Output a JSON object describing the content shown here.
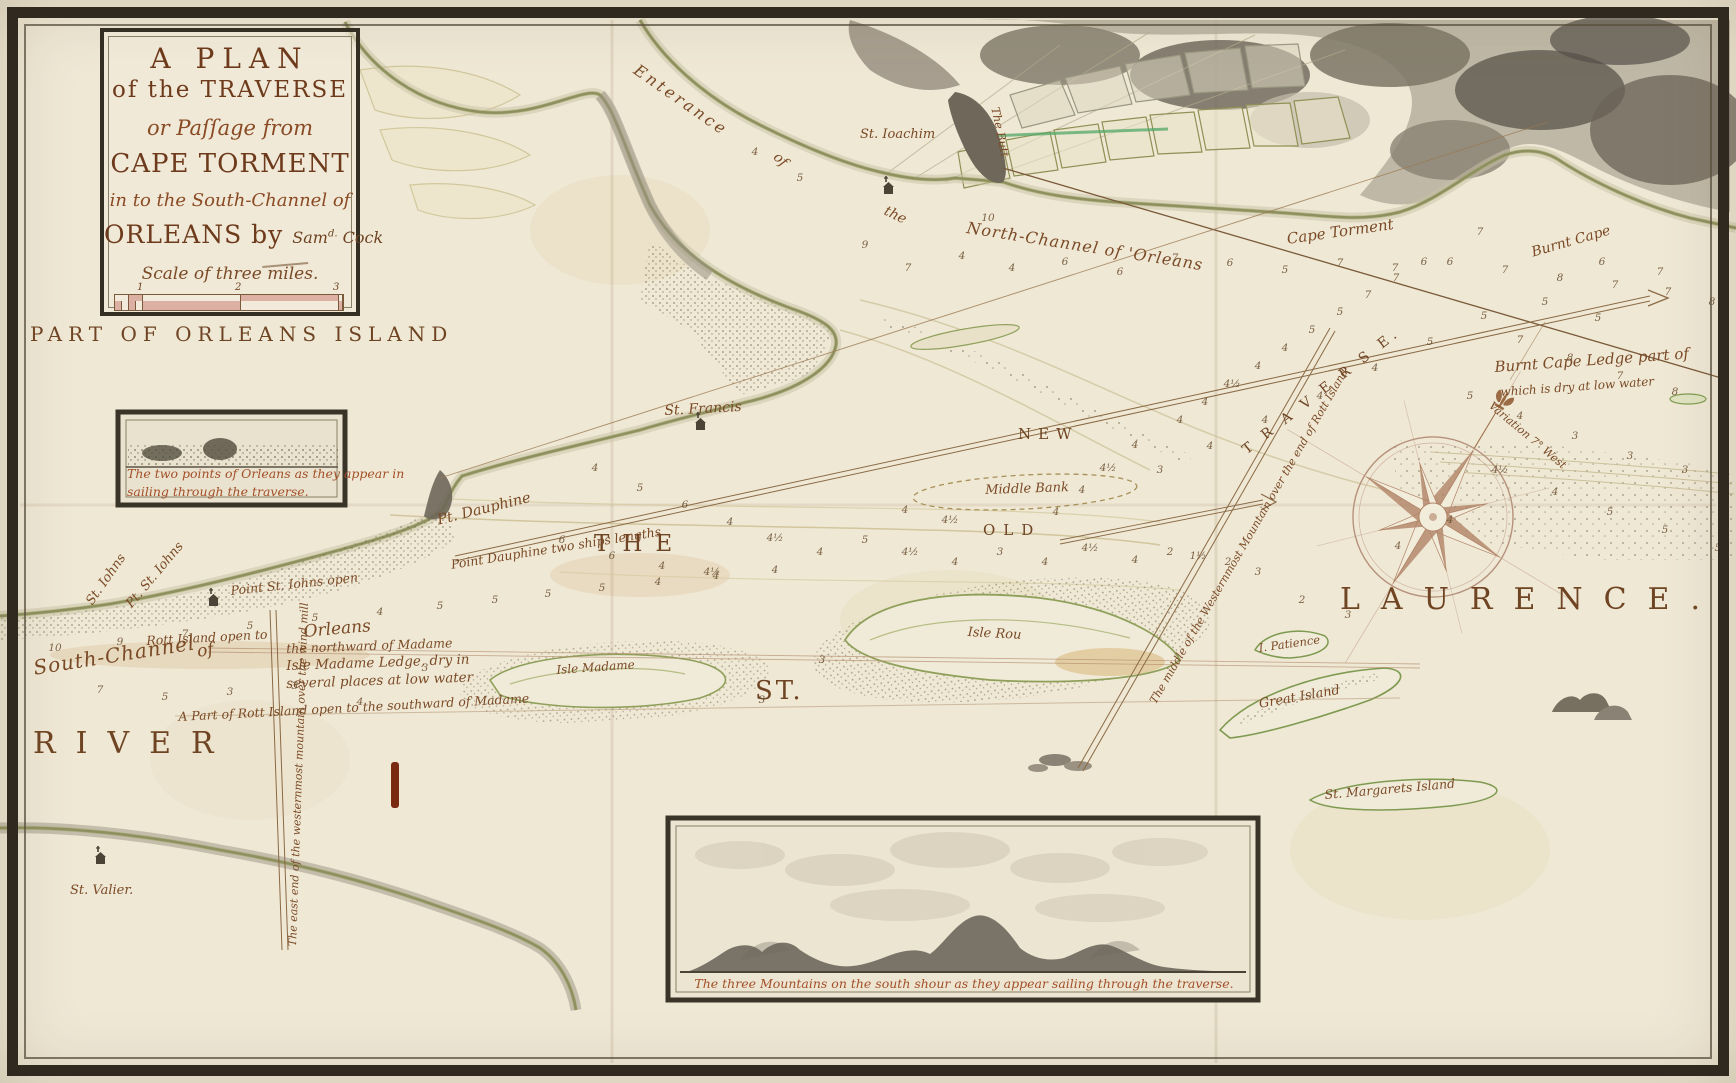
{
  "cartouche": {
    "line1": "A PLAN",
    "line2": "of the TRAVERSE",
    "line3": "or Paſſage from",
    "line4": "CAPE TORMENT",
    "line5": "in to the South-Channel of",
    "line6": "ORLEANS by",
    "signature_main": "Sam",
    "signature_sup": "d.",
    "signature_rest": " Cock",
    "scale_label": "Scale of three miles.",
    "scale_ticks": [
      "1",
      "2",
      "3"
    ]
  },
  "region_title": "PART OF ORLEANS ISLAND",
  "insets": {
    "orleans_points": {
      "caption_line1": "The two points of Orleans as they appear in",
      "caption_line2": "sailing through the traverse."
    },
    "three_mountains": {
      "caption": "The three Mountains on the south shour as they appear sailing through the traverse."
    }
  },
  "colors": {
    "ink": "#7a4a26",
    "title_ink": "#6e3a1c",
    "caption_red": "#a34f28",
    "paper": "#efe8d5",
    "frame": "#2f2920",
    "shore_green": "#9aa35e",
    "terrain_gray": "#7d7568",
    "scale_pink": "#ddb0a4"
  },
  "labels": [
    {
      "name": "region-title",
      "text": "PART OF ORLEANS ISLAND",
      "x": 30,
      "y": 324,
      "fs": 20,
      "ls": 6,
      "cls": "caps"
    },
    {
      "name": "enterance-label",
      "text": "Enterance",
      "x": 640,
      "y": 62,
      "fs": 16,
      "rot": 35,
      "ls": 3,
      "cls": "hand"
    },
    {
      "name": "enterance-of",
      "text": "of",
      "x": 780,
      "y": 150,
      "fs": 14,
      "rot": 42,
      "cls": "hand"
    },
    {
      "name": "enterance-the",
      "text": "the",
      "x": 888,
      "y": 204,
      "fs": 14,
      "rot": 26,
      "cls": "hand"
    },
    {
      "name": "north-channel-label",
      "text": "North-Channel of 'Orleans",
      "x": 968,
      "y": 220,
      "fs": 16,
      "rot": 9,
      "ls": 1,
      "cls": "hand"
    },
    {
      "name": "st-joachim-label",
      "text": "St. Ioachim",
      "x": 860,
      "y": 128,
      "fs": 13,
      "cls": "hand"
    },
    {
      "name": "the-butt-label",
      "text": "The Butt",
      "x": 1001,
      "y": 106,
      "fs": 11.5,
      "rot": 78,
      "cls": "hand"
    },
    {
      "name": "cape-torment-label",
      "text": "Cape Torment",
      "x": 1286,
      "y": 232,
      "fs": 15,
      "rot": -8,
      "cls": "hand"
    },
    {
      "name": "burnt-cape-label",
      "text": "Burnt Cape",
      "x": 1530,
      "y": 246,
      "fs": 14,
      "rot": -16,
      "cls": "hand"
    },
    {
      "name": "burnt-cape-ledge-label",
      "text": "Burnt Cape Ledge part of",
      "x": 1494,
      "y": 360,
      "fs": 15,
      "rot": -4,
      "cls": "hand"
    },
    {
      "name": "dry-at-low-water-label",
      "text": "which is dry at low water",
      "x": 1500,
      "y": 386,
      "fs": 12,
      "rot": -4,
      "cls": "hand"
    },
    {
      "name": "variation-label",
      "text": "Variation 7° West",
      "x": 1494,
      "y": 400,
      "fs": 11,
      "rot": 40,
      "cls": "hand"
    },
    {
      "name": "new-channel-label",
      "text": "NEW",
      "x": 1018,
      "y": 427,
      "fs": 15,
      "ls": 7,
      "cls": "caps"
    },
    {
      "name": "middle-bank-label",
      "text": "Middle Bank",
      "x": 985,
      "y": 484,
      "fs": 13,
      "rot": -2,
      "cls": "hand"
    },
    {
      "name": "old-channel-label",
      "text": "OLD",
      "x": 983,
      "y": 523,
      "fs": 15,
      "ls": 8,
      "cls": "caps"
    },
    {
      "name": "the-word",
      "text": "THE",
      "x": 594,
      "y": 532,
      "fs": 23,
      "ls": 13,
      "cls": "caps"
    },
    {
      "name": "st-word",
      "text": "ST.",
      "x": 755,
      "y": 678,
      "fs": 26,
      "ls": 3,
      "cls": "caps"
    },
    {
      "name": "laurence-word",
      "text": "LAURENCE.",
      "x": 1340,
      "y": 584,
      "fs": 30,
      "ls": 21,
      "cls": "caps"
    },
    {
      "name": "river-word",
      "text": "RIVER",
      "x": 33,
      "y": 728,
      "fs": 30,
      "ls": 20,
      "cls": "caps"
    },
    {
      "name": "traverse-word",
      "text": "T R A V E R S E.",
      "x": 1240,
      "y": 446,
      "fs": 14,
      "ls": 5,
      "rot": -38,
      "cls": "caps"
    },
    {
      "name": "st-francis-label",
      "text": "St. Francis",
      "x": 664,
      "y": 404,
      "fs": 14,
      "rot": -3,
      "cls": "hand"
    },
    {
      "name": "pt-dauphine-label",
      "text": "Pt. Dauphine",
      "x": 436,
      "y": 514,
      "fs": 14.5,
      "rot": -14,
      "cls": "hand"
    },
    {
      "name": "pt-dauphine-leading-label",
      "text": "Point Dauphine two ships lengths",
      "x": 450,
      "y": 558,
      "fs": 12.5,
      "rot": -9,
      "cls": "hand"
    },
    {
      "name": "st-johns-label",
      "text": "St. Iohns",
      "x": 84,
      "y": 600,
      "fs": 13,
      "rot": -55,
      "cls": "hand"
    },
    {
      "name": "pt-st-johns-label",
      "text": "Pt. St. Iohns",
      "x": 124,
      "y": 602,
      "fs": 13,
      "rot": -50,
      "cls": "hand"
    },
    {
      "name": "pt-st-johns-leading-label",
      "text": "Point St. Iohns open",
      "x": 230,
      "y": 584,
      "fs": 12.5,
      "rot": -6,
      "cls": "hand"
    },
    {
      "name": "south-channel-label",
      "text": "South-Channel",
      "x": 32,
      "y": 658,
      "fs": 20,
      "rot": -9,
      "ls": 1,
      "cls": "hand"
    },
    {
      "name": "south-channel-of",
      "text": "of",
      "x": 196,
      "y": 644,
      "fs": 17,
      "rot": -9,
      "cls": "hand"
    },
    {
      "name": "south-channel-orleans",
      "text": "Orleans",
      "x": 303,
      "y": 624,
      "fs": 17,
      "rot": -5,
      "cls": "hand"
    },
    {
      "name": "rott-island-north-label",
      "text": "Rott Island open to",
      "x": 146,
      "y": 634,
      "fs": 12.5,
      "rot": -3,
      "cls": "hand"
    },
    {
      "name": "northward-madame-label",
      "text": "the northward of Madame",
      "x": 286,
      "y": 642,
      "fs": 12.5,
      "rot": -2,
      "cls": "hand"
    },
    {
      "name": "madame-ledge-label-1",
      "text": "Isle Madame Ledge, dry in",
      "x": 286,
      "y": 659,
      "fs": 13.5,
      "rot": -2,
      "cls": "hand"
    },
    {
      "name": "madame-ledge-label-2",
      "text": "several places at low water",
      "x": 286,
      "y": 677,
      "fs": 13.5,
      "rot": -2,
      "cls": "hand"
    },
    {
      "name": "rott-island-south-label",
      "text": "A Part of Rott Island open to the southward of Madame",
      "x": 178,
      "y": 710,
      "fs": 12.5,
      "rot": -3,
      "cls": "hand"
    },
    {
      "name": "isle-madame-label",
      "text": "Isle Madame",
      "x": 556,
      "y": 664,
      "fs": 12,
      "rot": -4,
      "cls": "hand"
    },
    {
      "name": "isle-rou-label",
      "text": "Isle Rou",
      "x": 968,
      "y": 626,
      "fs": 13,
      "rot": 3,
      "cls": "hand"
    },
    {
      "name": "patience-label",
      "text": "I. Patience",
      "x": 1258,
      "y": 642,
      "fs": 11.5,
      "rot": -8,
      "cls": "hand"
    },
    {
      "name": "great-island-label",
      "text": "Great Island",
      "x": 1258,
      "y": 698,
      "fs": 13,
      "rot": -10,
      "cls": "hand"
    },
    {
      "name": "st-margarets-label",
      "text": "St. Margarets Island",
      "x": 1324,
      "y": 788,
      "fs": 12.5,
      "rot": -5,
      "cls": "hand"
    },
    {
      "name": "st-valier-label",
      "text": "St. Valier.",
      "x": 70,
      "y": 884,
      "fs": 13,
      "cls": "hand"
    },
    {
      "name": "east-end-bearing-label",
      "text": "The east end of the westernmost mountain over the wind mill",
      "x": 287,
      "y": 946,
      "fs": 11,
      "rot": -88,
      "cls": "hand"
    },
    {
      "name": "middle-mountain-bearing-label",
      "text": "The middle of the Westernmost Mountain over the end of Rott Island",
      "x": 1148,
      "y": 700,
      "fs": 11,
      "rot": -60,
      "cls": "hand"
    }
  ],
  "soundings": [
    [
      755,
      152,
      "4"
    ],
    [
      800,
      178,
      "5"
    ],
    [
      988,
      218,
      "10"
    ],
    [
      865,
      245,
      "9"
    ],
    [
      908,
      268,
      "7"
    ],
    [
      962,
      256,
      "4"
    ],
    [
      1012,
      268,
      "4"
    ],
    [
      1065,
      262,
      "6"
    ],
    [
      1120,
      272,
      "6"
    ],
    [
      1175,
      258,
      "7"
    ],
    [
      1230,
      263,
      "6"
    ],
    [
      1285,
      270,
      "5"
    ],
    [
      1340,
      263,
      "7"
    ],
    [
      1395,
      268,
      "7"
    ],
    [
      1450,
      262,
      "6"
    ],
    [
      1505,
      270,
      "7"
    ],
    [
      1560,
      278,
      "8"
    ],
    [
      1615,
      285,
      "7"
    ],
    [
      1668,
      292,
      "7"
    ],
    [
      1712,
      302,
      "8"
    ],
    [
      1480,
      232,
      "7"
    ],
    [
      1602,
      262,
      "6"
    ],
    [
      1660,
      272,
      "7"
    ],
    [
      1180,
      420,
      "4"
    ],
    [
      1205,
      402,
      "4"
    ],
    [
      1232,
      384,
      "4½"
    ],
    [
      1258,
      366,
      "4"
    ],
    [
      1285,
      348,
      "4"
    ],
    [
      1312,
      330,
      "5"
    ],
    [
      1340,
      312,
      "5"
    ],
    [
      1368,
      295,
      "7"
    ],
    [
      1396,
      278,
      "7"
    ],
    [
      1424,
      262,
      "6"
    ],
    [
      1135,
      445,
      "4"
    ],
    [
      1108,
      468,
      "4½"
    ],
    [
      1082,
      490,
      "4"
    ],
    [
      1056,
      512,
      "4"
    ],
    [
      1160,
      470,
      "3"
    ],
    [
      1210,
      446,
      "4"
    ],
    [
      1265,
      420,
      "4"
    ],
    [
      1320,
      396,
      "4"
    ],
    [
      1375,
      368,
      "4"
    ],
    [
      1430,
      342,
      "5"
    ],
    [
      1484,
      316,
      "5"
    ],
    [
      1520,
      340,
      "7"
    ],
    [
      1570,
      358,
      "8"
    ],
    [
      1620,
      376,
      "7"
    ],
    [
      1675,
      392,
      "8"
    ],
    [
      1722,
      408,
      "7"
    ],
    [
      1545,
      302,
      "5"
    ],
    [
      1598,
      318,
      "5"
    ],
    [
      1470,
      396,
      "5"
    ],
    [
      1520,
      416,
      "4"
    ],
    [
      1575,
      436,
      "3"
    ],
    [
      1630,
      456,
      "3"
    ],
    [
      1685,
      470,
      "3"
    ],
    [
      1726,
      486,
      "3"
    ],
    [
      1500,
      470,
      "4½"
    ],
    [
      1555,
      492,
      "4"
    ],
    [
      1610,
      512,
      "5"
    ],
    [
      1665,
      530,
      "5"
    ],
    [
      1718,
      548,
      "5"
    ],
    [
      1450,
      520,
      "4"
    ],
    [
      1398,
      546,
      "4"
    ],
    [
      595,
      468,
      "4"
    ],
    [
      640,
      488,
      "5"
    ],
    [
      685,
      505,
      "6"
    ],
    [
      730,
      522,
      "4"
    ],
    [
      775,
      538,
      "4½"
    ],
    [
      820,
      552,
      "4"
    ],
    [
      865,
      540,
      "5"
    ],
    [
      910,
      552,
      "4½"
    ],
    [
      955,
      562,
      "4"
    ],
    [
      1000,
      552,
      "3"
    ],
    [
      1045,
      562,
      "4"
    ],
    [
      1090,
      548,
      "4½"
    ],
    [
      1135,
      560,
      "4"
    ],
    [
      562,
      540,
      "6"
    ],
    [
      612,
      556,
      "6"
    ],
    [
      662,
      566,
      "4"
    ],
    [
      712,
      572,
      "4½"
    ],
    [
      905,
      510,
      "4"
    ],
    [
      950,
      520,
      "4½"
    ],
    [
      55,
      648,
      "10"
    ],
    [
      120,
      642,
      "9"
    ],
    [
      185,
      634,
      "7"
    ],
    [
      250,
      626,
      "5"
    ],
    [
      315,
      618,
      "5"
    ],
    [
      380,
      612,
      "4"
    ],
    [
      440,
      606,
      "5"
    ],
    [
      495,
      600,
      "5"
    ],
    [
      548,
      594,
      "5"
    ],
    [
      602,
      588,
      "5"
    ],
    [
      658,
      582,
      "4"
    ],
    [
      716,
      576,
      "4"
    ],
    [
      775,
      570,
      "4"
    ],
    [
      100,
      690,
      "7"
    ],
    [
      165,
      697,
      "5"
    ],
    [
      230,
      692,
      "3"
    ],
    [
      295,
      686,
      "3"
    ],
    [
      360,
      702,
      "4"
    ],
    [
      425,
      668,
      "3"
    ],
    [
      762,
      700,
      "3"
    ],
    [
      822,
      660,
      "3"
    ],
    [
      1170,
      552,
      "2"
    ],
    [
      1198,
      556,
      "1½"
    ],
    [
      1228,
      562,
      "2"
    ],
    [
      1258,
      572,
      "3"
    ],
    [
      1302,
      600,
      "2"
    ],
    [
      1348,
      615,
      "3"
    ]
  ]
}
